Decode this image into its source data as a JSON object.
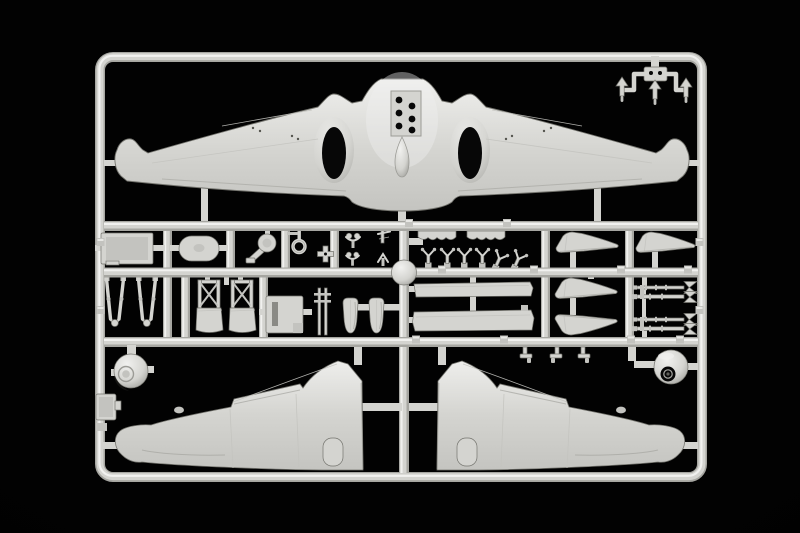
{
  "scene": {
    "description": "Product photo of a light-grey injection-moulded plastic model kit sprue (parts tree) of an aircraft, on a black background",
    "background_name": "black studio backdrop",
    "plastic_color_name": "light grey styrene"
  },
  "colors": {
    "background": "#020202",
    "plastic_base": "#d4d4d0",
    "plastic_highlight": "#f1f1ef",
    "plastic_mid": "#c3c3bf",
    "plastic_shadow": "#9b9b96",
    "plastic_rail_shadow": "#a6a6a1",
    "plastic_edge": "#74746e",
    "dark_opening": "#070707"
  },
  "sprue": {
    "frame_shape": "rounded-rectangle",
    "runner_rows": 3,
    "parts": [
      {
        "name": "one-piece-wing-with-fuselage-underside",
        "count": 1,
        "location": "top",
        "features": [
          "two dark oval gear openings",
          "teardrop fairing",
          "six vent holes",
          "hooked wing tips"
        ]
      },
      {
        "name": "small-fittings-runner",
        "count": 1,
        "location": "top-right-corner",
        "features": [
          "three arrow-shaped fittings hanging from top rail"
        ]
      },
      {
        "name": "instrument-panel",
        "count": 1,
        "location": "middle-band-upper-left"
      },
      {
        "name": "oval-hatch-panel",
        "count": 1,
        "location": "middle-band-upper"
      },
      {
        "name": "disc-with-arm",
        "count": 1,
        "location": "middle-band-upper"
      },
      {
        "name": "ring-handle",
        "count": 1,
        "location": "middle-band-upper"
      },
      {
        "name": "cross-fitting",
        "count": 1,
        "location": "middle-band-upper"
      },
      {
        "name": "control-yoke-small-parts",
        "count": 4,
        "location": "middle-band-upper"
      },
      {
        "name": "exhaust-strip",
        "count": 2,
        "location": "middle-band-upper"
      },
      {
        "name": "y-shaped-fitting",
        "count": 6,
        "location": "middle-band-upper"
      },
      {
        "name": "wheel-spat-half",
        "count": 4,
        "location": "middle-band-right"
      },
      {
        "name": "landing-gear-strut",
        "count": 2,
        "location": "middle-band-lower-left"
      },
      {
        "name": "seat-with-x-harness",
        "count": 2,
        "location": "middle-band-lower"
      },
      {
        "name": "radiator-box",
        "count": 1,
        "location": "middle-band-lower"
      },
      {
        "name": "ladder-strut",
        "count": 1,
        "location": "middle-band-lower"
      },
      {
        "name": "wheel-half",
        "count": 2,
        "location": "middle-band-lower"
      },
      {
        "name": "flap-panel",
        "count": 2,
        "location": "middle-band-lower"
      },
      {
        "name": "machine-gun-with-fins",
        "count": 4,
        "location": "middle-band-lower-right"
      },
      {
        "name": "small-bracket-clip",
        "count": 3,
        "location": "below-middle-band"
      },
      {
        "name": "cowling-ball-half",
        "count": 2,
        "location": "bottom-left-and-bottom-right"
      },
      {
        "name": "lower-wing-half",
        "count": 2,
        "location": "bottom",
        "features": [
          "hooked tip",
          "raised root step",
          "round access bump"
        ]
      },
      {
        "name": "access-hatch-on-rail",
        "count": 1,
        "location": "bottom-left-rail"
      }
    ]
  }
}
